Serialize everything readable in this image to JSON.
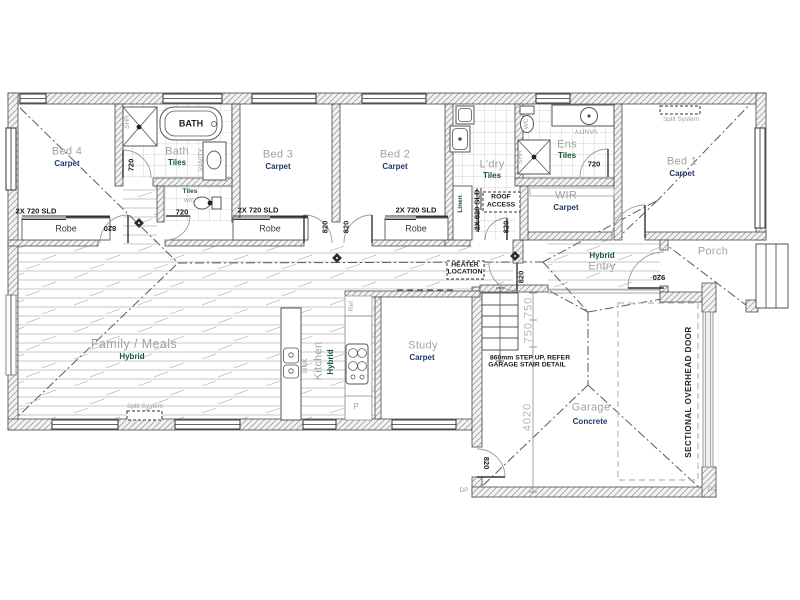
{
  "drawing": {
    "title": "Residential floor plan",
    "rooms": {
      "bed1": {
        "name": "Bed 1",
        "material": "Carpet"
      },
      "bed2": {
        "name": "Bed 2",
        "material": "Carpet"
      },
      "bed3": {
        "name": "Bed 3",
        "material": "Carpet"
      },
      "bed4": {
        "name": "Bed 4",
        "material": "Carpet"
      },
      "bath": {
        "name": "Bath",
        "material": "Tiles"
      },
      "wc": {
        "name": "w/c",
        "material": "Tiles"
      },
      "laundry": {
        "name": "L'dry",
        "material": "Tiles"
      },
      "ens": {
        "name": "Ens",
        "material": "Tiles"
      },
      "wir": {
        "name": "WIR",
        "material": "Carpet"
      },
      "family": {
        "name": "Family / Meals",
        "material": "Hybrid"
      },
      "kitchen": {
        "name": "Kitchen",
        "material": "Hybrid"
      },
      "study": {
        "name": "Study",
        "material": "Carpet"
      },
      "entry": {
        "name": "Entry",
        "material": "Hybrid"
      },
      "garage": {
        "name": "Garage",
        "material": "Concrete"
      },
      "porch": {
        "name": "Porch"
      },
      "robe": "Robe",
      "linen": "Linen"
    },
    "fixtures": {
      "bath_tub": "BATH",
      "sink": "SINK",
      "fridge": "Ref",
      "pantry": "P",
      "vanity": "VANITY",
      "shower": "SHR",
      "toilet": "WC",
      "split_system": "Split System",
      "roof_access_line1": "ROOF",
      "roof_access_line2": "ACCESS",
      "heater_line1": "HEATER",
      "heater_line2": "LOCATION",
      "sectional_door": "SECTIONAL OVERHEAD DOOR",
      "downpipe": "DP"
    },
    "doors": {
      "robe_slider": "2X 720 SLD",
      "laundry_slider": "2X 820 SLD",
      "d820": "820",
      "d720": "720",
      "d920": "920"
    },
    "dims": {
      "stair_risers": "750 750",
      "garage_depth": "4020",
      "note_line1": "860mm STEP UP, REFER",
      "note_line2": "GARAGE STAIR DETAIL"
    },
    "colors": {
      "carpet_label": "#1f3a68",
      "tiles_label": "#17552e",
      "hybrid_label": "#14564c",
      "concrete_label": "#1f3a68",
      "room_label": "#a2a2a2",
      "dim_gray": "#b5b5b5",
      "linework": "#4a4a4a"
    }
  }
}
